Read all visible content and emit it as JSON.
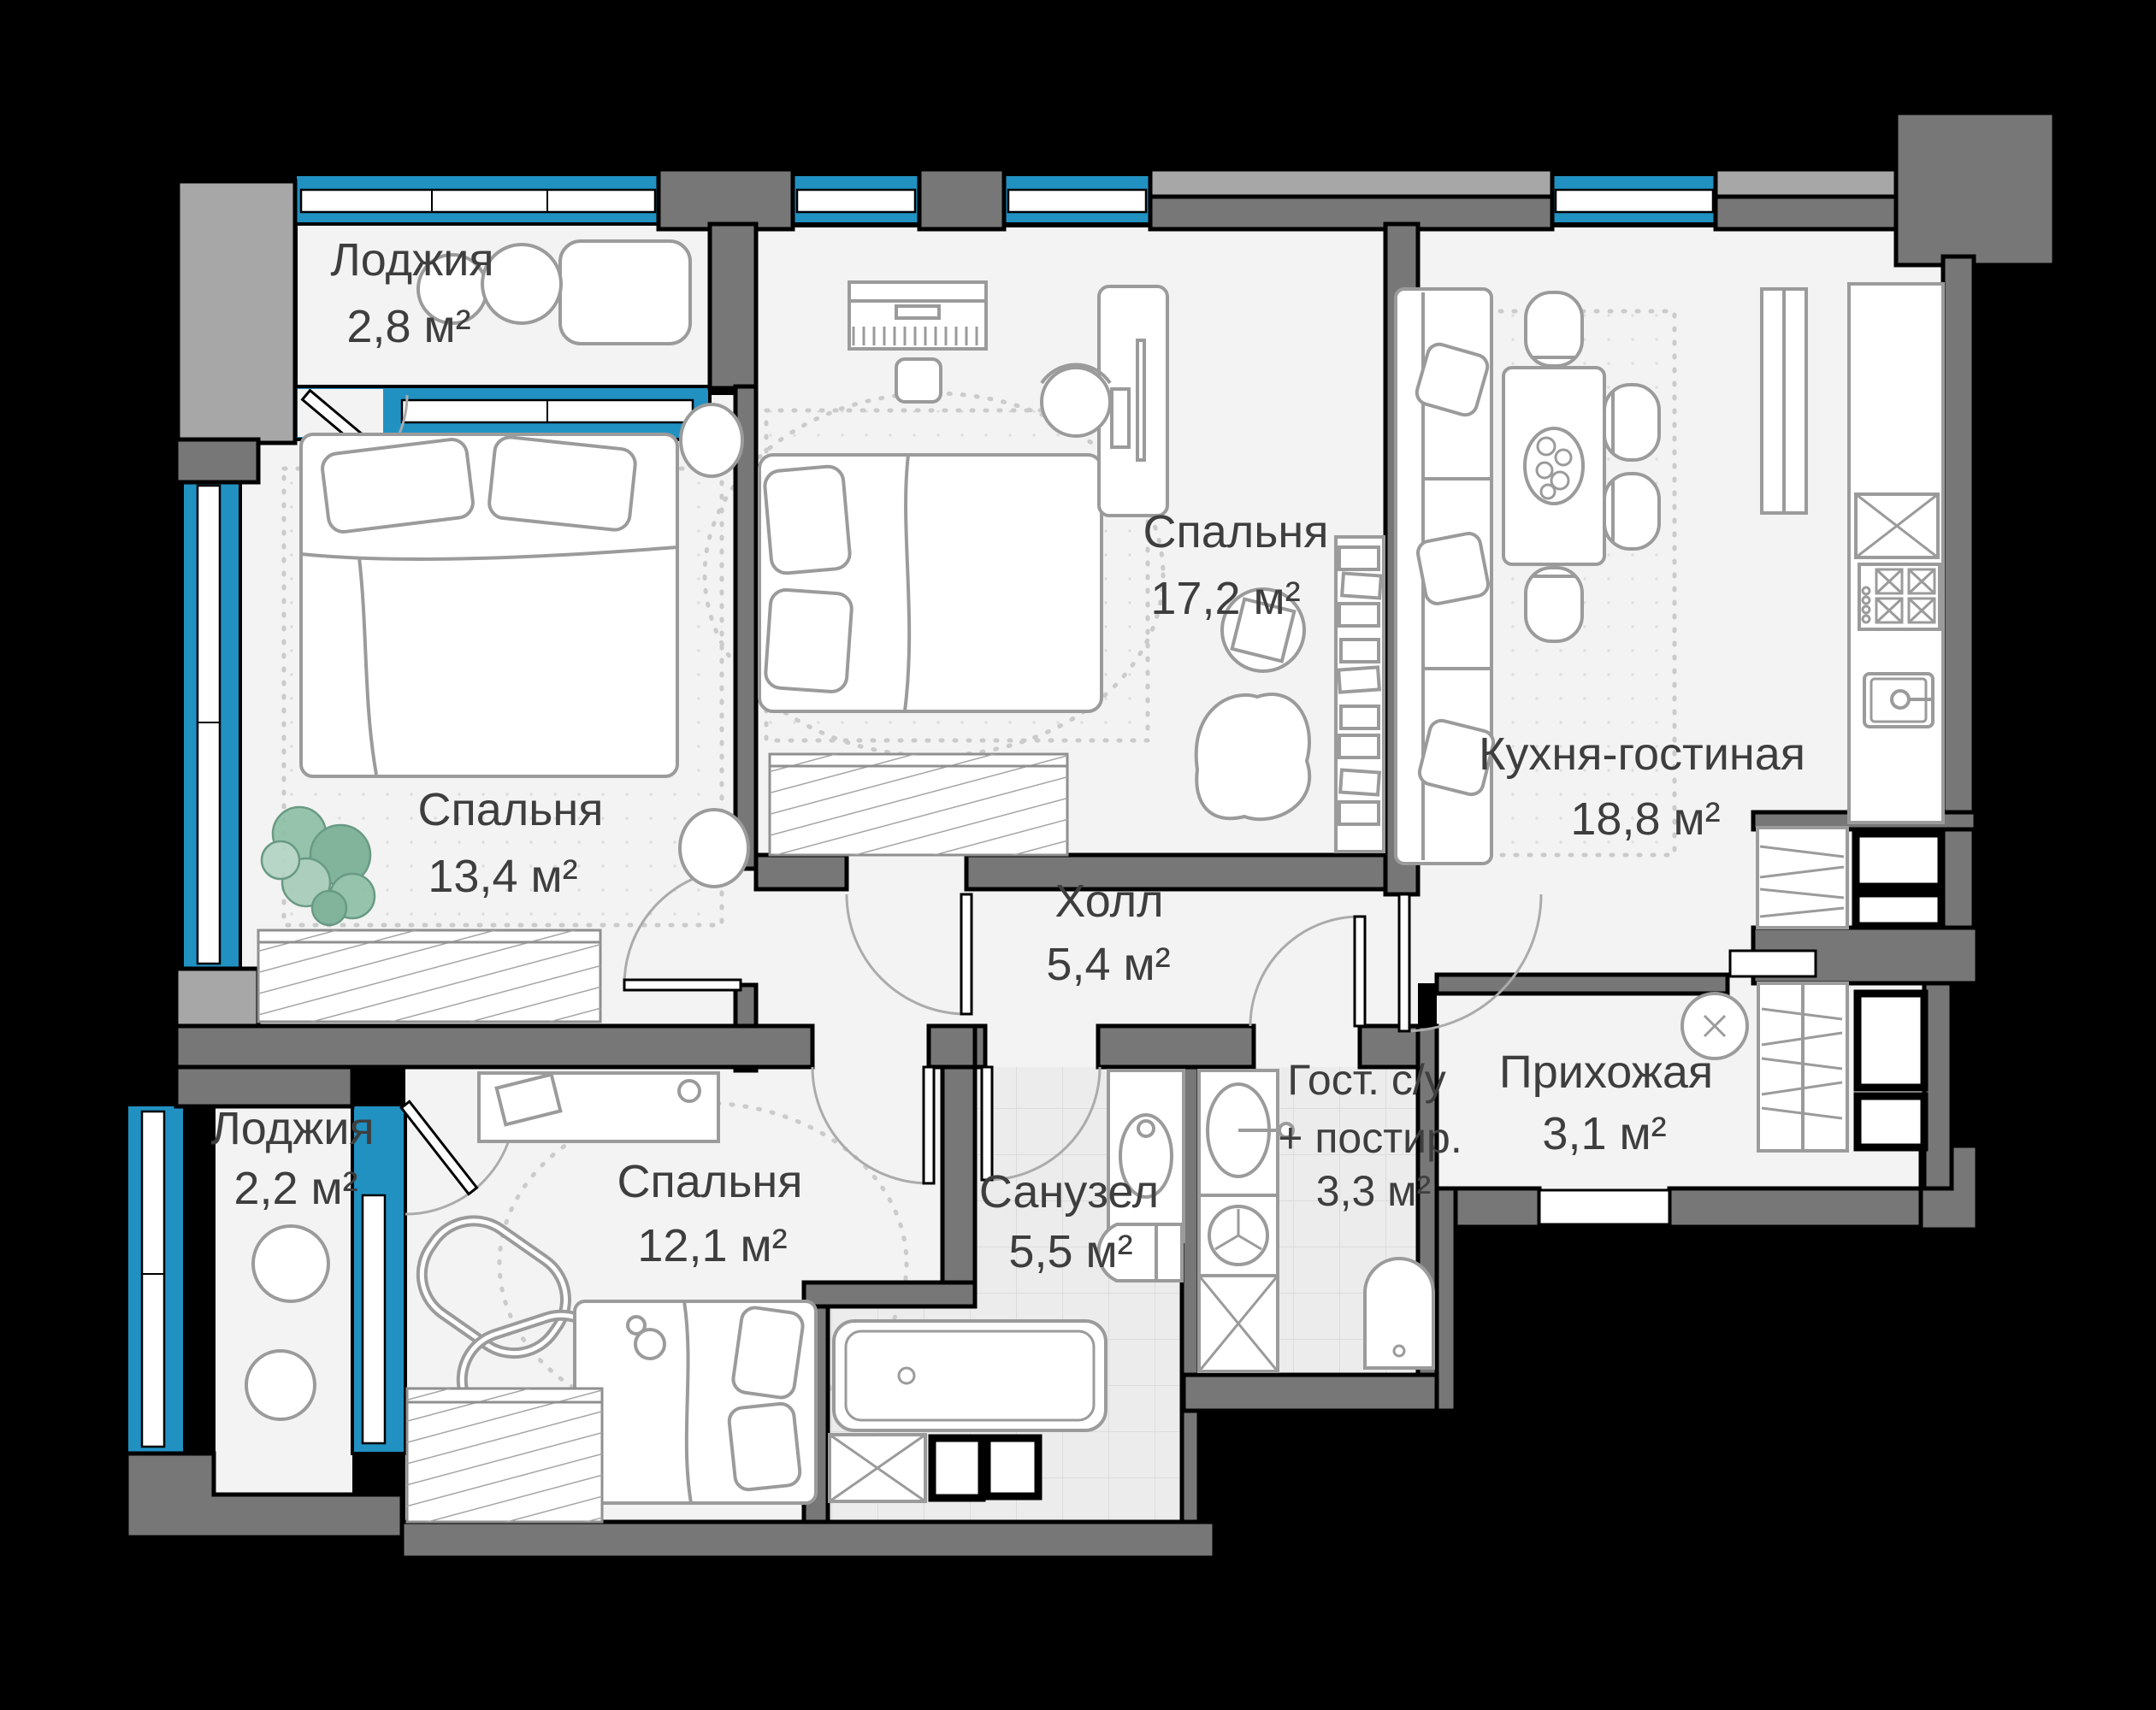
{
  "plan": {
    "title": "apartment floor plan",
    "colors": {
      "background": "#000000",
      "wall": "#777777",
      "outer_pier": "#a7a7a7",
      "glazing": "#2191c2",
      "floor": "#f3f3f3",
      "wet_floor": "#ececec",
      "furniture_line": "#9b9b9b",
      "label": "#3e3e3e",
      "plant": "#8fbfa6"
    },
    "rooms": [
      {
        "id": "loggia-top",
        "name": "Лоджия",
        "area": "2,8 м²"
      },
      {
        "id": "bedroom-left",
        "name": "Спальня",
        "area": "13,4 м²"
      },
      {
        "id": "bedroom-top",
        "name": "Спальня",
        "area": "17,2 м²"
      },
      {
        "id": "kitchen-living",
        "name": "Кухня-гостиная",
        "area": "18,8 м²"
      },
      {
        "id": "hall",
        "name": "Холл",
        "area": "5,4 м²"
      },
      {
        "id": "loggia-bottom",
        "name": "Лоджия",
        "area": "2,2 м²"
      },
      {
        "id": "bedroom-bottom",
        "name": "Спальня",
        "area": "12,1 м²"
      },
      {
        "id": "bathroom",
        "name": "Санузел",
        "area": "5,5 м²"
      },
      {
        "id": "guest-wc",
        "name": "Гост. с/у",
        "name_line2": "+ постир.",
        "area": "3,3 м²"
      },
      {
        "id": "entry-hall",
        "name": "Прихожая",
        "area": "3,1 м²"
      }
    ]
  }
}
